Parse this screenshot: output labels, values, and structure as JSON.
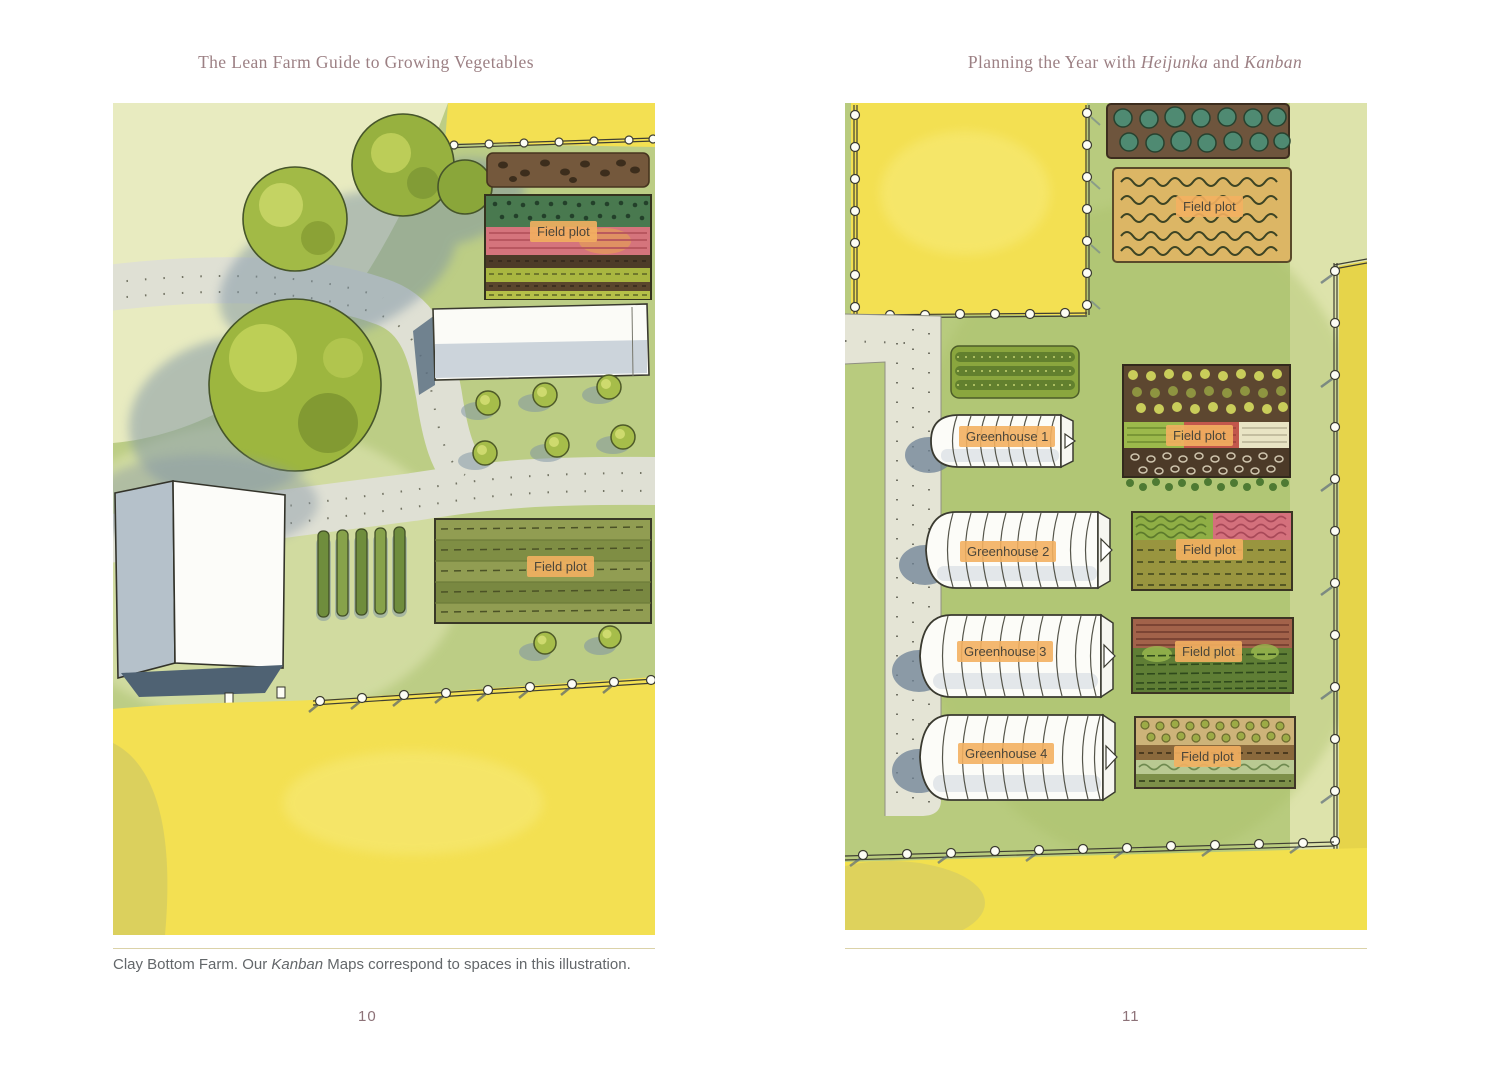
{
  "book": {
    "left_running_head": "The Lean Farm Guide to Growing Vegetables",
    "right_running_head": {
      "prefix": "Planning the Year with ",
      "term1": "Heijunka",
      "conjunction": " and ",
      "term2": "Kanban"
    },
    "caption": {
      "prefix": "Clay Bottom Farm. Our ",
      "term": "Kanban",
      "suffix": " Maps correspond to spaces in this illustration."
    },
    "left_page_number": "10",
    "right_page_number": "11"
  },
  "left_map": {
    "field_plot_upper": "Field plot",
    "field_plot_lower": "Field plot"
  },
  "right_map": {
    "field_plot_top": "Field plot",
    "greenhouse_1": "Greenhouse 1",
    "greenhouse_2": "Greenhouse 2",
    "greenhouse_3": "Greenhouse 3",
    "greenhouse_4": "Greenhouse 4",
    "field_plot_1": "Field plot",
    "field_plot_2": "Field plot",
    "field_plot_3": "Field plot",
    "field_plot_4": "Field plot"
  },
  "colors": {
    "label_bg": "#f3b061",
    "label_text": "#4b463a",
    "heading_text": "#9c8084",
    "caption_text": "#63676a",
    "rule": "#dbd2a8",
    "map_green": "#bccd85",
    "field_yellow": "#f3e052"
  }
}
